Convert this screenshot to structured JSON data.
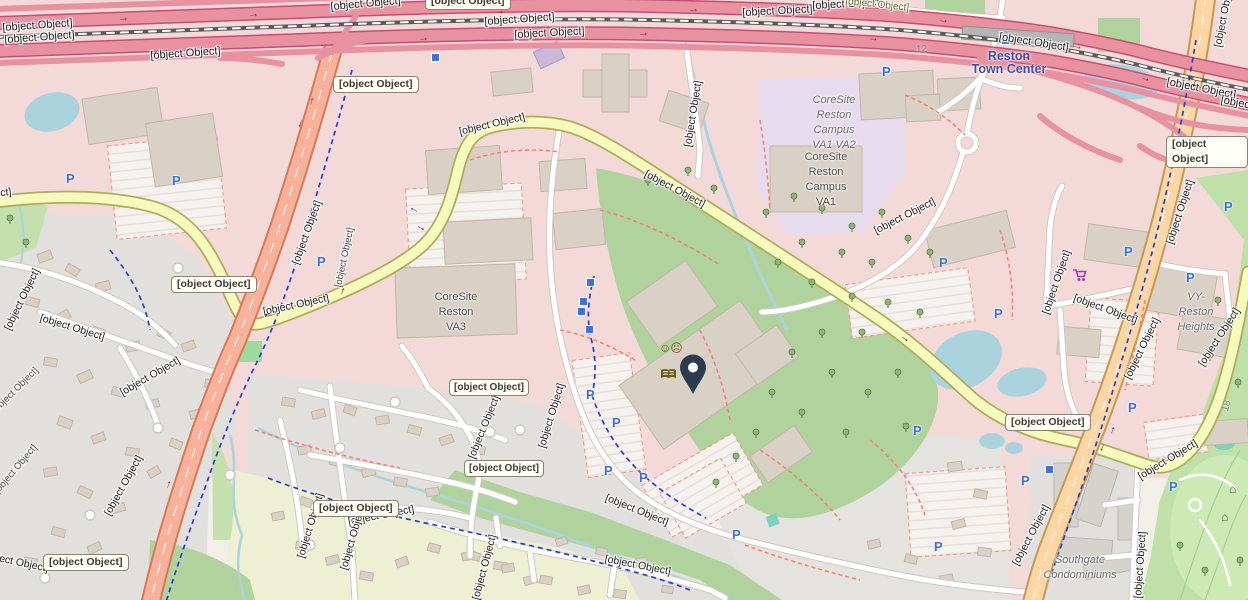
{
  "region": {
    "description": "Street map around Sunrise Valley Drive and Reston Parkway"
  },
  "station": {
    "line1": "Reston",
    "line2": "Town Center"
  },
  "route_markers": [
    "12",
    "18"
  ],
  "shields": [
    {
      "text": "VA 267"
    },
    {
      "text": "VA 286"
    },
    {
      "text": "VA 286"
    },
    {
      "text": "SR 602"
    },
    {
      "text": "SR 5320"
    },
    {
      "text": "SR 5320"
    },
    {
      "text": "SR 4721"
    },
    {
      "text": "VA"
    },
    {
      "text": "VA"
    }
  ],
  "road_labels": [
    {
      "text": "Dulles Toll Road"
    },
    {
      "text": "Dulles Access Road"
    },
    {
      "text": "Dulles Toll Road"
    },
    {
      "text": "Dulles Toll Road"
    },
    {
      "text": "Dulles Access Road"
    },
    {
      "text": "Dulles Toll Road"
    },
    {
      "text": "Dulles Access Road"
    },
    {
      "text": "Dulles Toll Road"
    },
    {
      "text": "Dulles Access Road"
    },
    {
      "text": "Dulles Access Road"
    },
    {
      "text": "Dulles Access Road"
    },
    {
      "text": "Sunrise Valley Drive"
    },
    {
      "text": "Sunrise Valley Drive"
    },
    {
      "text": "Sunrise Valley Drive"
    },
    {
      "text": "Sunrise Valley Drive"
    },
    {
      "text": "Fairfax County Parkway"
    },
    {
      "text": "Fairfax County Parkway Trail"
    },
    {
      "text": "Fairfax County Parkway"
    },
    {
      "text": "Stirrup Iron Lane"
    },
    {
      "text": "Cross Country Lane"
    },
    {
      "text": "Halter Lane"
    },
    {
      "text": "Bridoon Lane"
    },
    {
      "text": "Drive"
    },
    {
      "text": "Drive"
    },
    {
      "text": "US Geological Survey Drive"
    },
    {
      "text": "US Geological Survey Drive"
    },
    {
      "text": "Sanibel Drive"
    },
    {
      "text": "Marginella Drive"
    },
    {
      "text": "Angel Wing Court"
    },
    {
      "text": "Glade Drive"
    },
    {
      "text": "Cocquina Drive"
    },
    {
      "text": "rnus Lane"
    },
    {
      "text": "Mercator Drive"
    },
    {
      "text": "Edmund Halley Drive"
    },
    {
      "text": "Sunset Hills Road"
    },
    {
      "text": "Fulton Place"
    },
    {
      "text": "Hopper Street"
    },
    {
      "text": "Reston Parkway"
    },
    {
      "text": "Reston Parkway"
    },
    {
      "text": "Reston Parkway"
    },
    {
      "text": "Reston Parkway"
    },
    {
      "text": "Sunrise Valley Drive"
    },
    {
      "text": "Sunrise Valley Drive"
    },
    {
      "text": "s Neck Road"
    }
  ],
  "area_labels": {
    "coresite_va3": {
      "line1": "CoreSite",
      "line2": "Reston",
      "line3": "VA3"
    },
    "coresite_campus_va1_va2": {
      "line1": "CoreSite",
      "line2": "Reston",
      "line3": "Campus",
      "line4": "VA1 VA2"
    },
    "coresite_campus_va1": {
      "line1": "CoreSite",
      "line2": "Reston",
      "line3": "Campus",
      "line4": "VA1"
    },
    "vy_reston_heights": {
      "line1": "VY-Reston",
      "line2": "Heights"
    },
    "southgate": {
      "line1": "Southgate",
      "line2": "Condominiums"
    }
  },
  "icons": {
    "parking_glyph": "P",
    "oneway_arrow": "→",
    "shelter_glyph": "⌂",
    "theatre_glyph": "☺☹",
    "marker": "map-pin",
    "library": "open-book",
    "supermarket": "shopping-cart"
  },
  "colors": {
    "motorway": "#e891a1",
    "motorway_casing": "#c94d72",
    "trunk": "#f8b29b",
    "trunk_casing": "#d77a57",
    "primary": "#fcd6a4",
    "primary_casing": "#c49a56",
    "secondary": "#f6fabd",
    "secondary_casing": "#adad58",
    "water": "#abd3de",
    "pool_teal": "#7fd0bf",
    "green": "#b0d39e",
    "golf": "#bfe0a8",
    "field": "#edf0d2",
    "commercial_pink": "#f3dad8",
    "residential_gray": "#e1e0dd",
    "campus_lavender": "#e7dcee",
    "building": "#d9d0c6",
    "parking_blue": "#3a74d8",
    "marker_navy": "#2c3b50",
    "amenity_brown": "#6f5b12",
    "shop_purple": "#ac39ac",
    "station_blue": "#3f51a3"
  }
}
